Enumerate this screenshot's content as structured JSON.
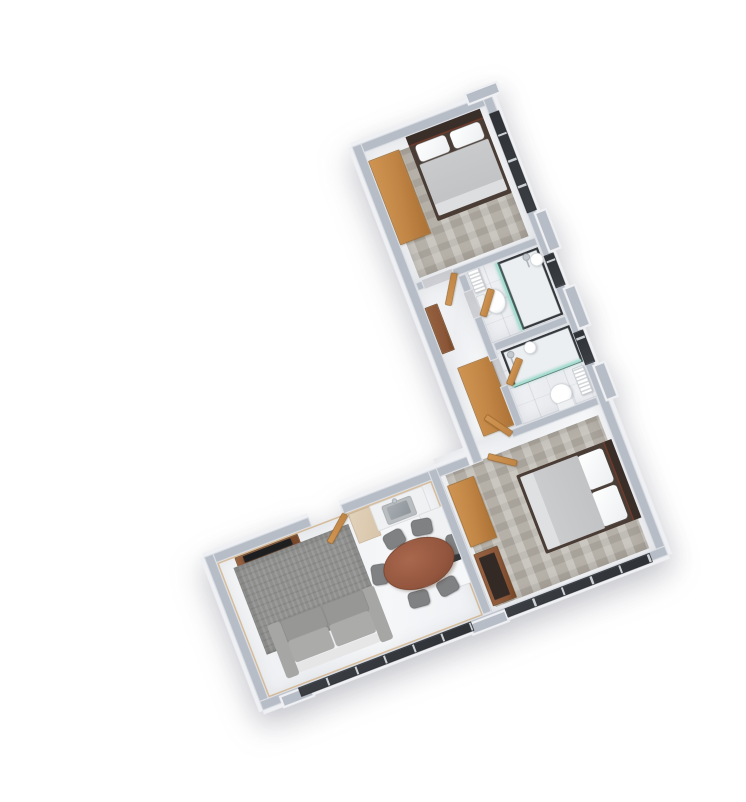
{
  "scene": {
    "type": "3d-floor-plan-render",
    "description": "Isometric top-down 3D render of an L-shaped two-bedroom apartment floor plan on a plain white background, rotated about 21 degrees counter-clockwise",
    "text_visible": "none",
    "rotation_deg": -21
  },
  "colors": {
    "background": "#ffffff",
    "wall-top": "#b7bdc7",
    "wall-outer": "#eff0f3",
    "floor-marble": "#f1f2f5",
    "carpet": "#b5b0a8",
    "wood": "#c08444",
    "wood-dark": "#8a5638",
    "table-wood": "#94563e",
    "fabric-gray": "#7f8183",
    "sofa-gray": "#a0a09e",
    "rug-gray": "#8f908e",
    "duvet": "#c2c3c5",
    "headboard": "#3a2e28",
    "window-glass": "#2f3236",
    "glass-teal": "#a8ded2",
    "fixture-white": "#fafbfc",
    "tv-black": "#1d1e20",
    "desk-top": "#332a26"
  },
  "rooms": [
    {
      "name": "Bedroom 1",
      "furniture": [
        "double bed with dark headboard",
        "oak wardrobe",
        "patterned grey carpet tiles",
        "full-height window"
      ]
    },
    {
      "name": "En-suite bathroom",
      "furniture": [
        "toilet",
        "wall radiator",
        "walk-in shower with glass screen",
        "round basin",
        "marble tile floor",
        "small window"
      ]
    },
    {
      "name": "Hallway",
      "furniture": [
        "oak storage closet",
        "oak cabinet",
        "marble floor",
        "interior doors"
      ]
    },
    {
      "name": "Bathroom 2",
      "furniture": [
        "toilet",
        "wall radiator",
        "walk-in shower with glass screen",
        "round basin",
        "marble tile floor",
        "small window"
      ]
    },
    {
      "name": "Bedroom 2",
      "furniture": [
        "double bed with dark headboard",
        "oak wardrobe",
        "desk with dark top",
        "patterned grey carpet tiles",
        "window band"
      ]
    },
    {
      "name": "Living / dining / kitchen",
      "furniture": [
        "grey two-seat sofa",
        "grey area rug",
        "walnut TV unit with television",
        "oval walnut dining table",
        "six grey dining chairs",
        "kitchen counter with steel sink",
        "beige base cabinet",
        "white appliance",
        "entrance door",
        "window band"
      ]
    }
  ]
}
